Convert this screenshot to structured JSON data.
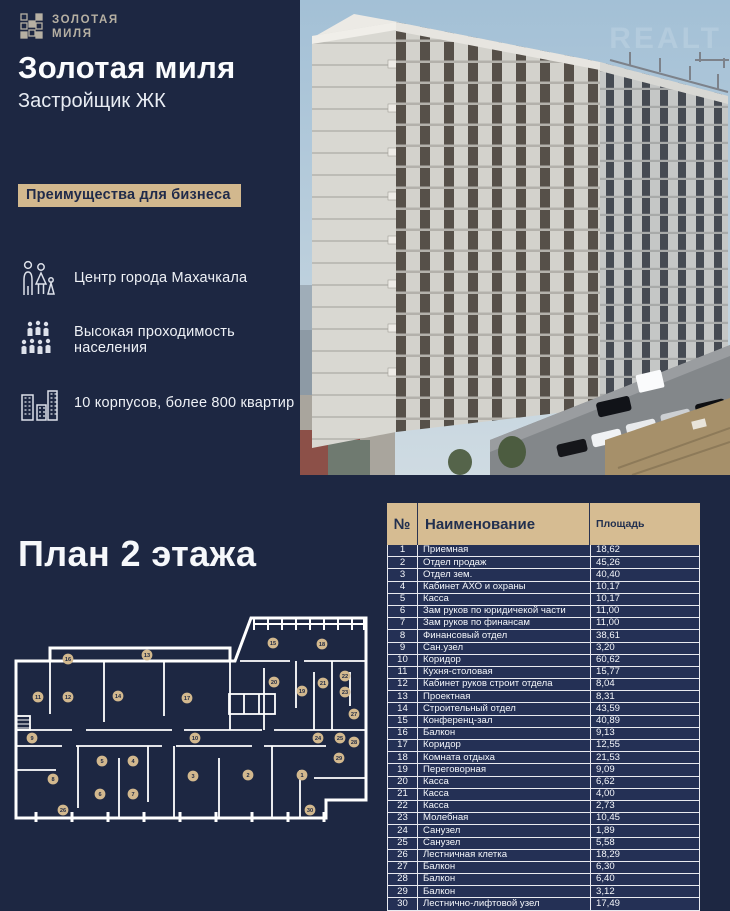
{
  "brand": {
    "logo_line1": "ЗОЛОТАЯ",
    "logo_line2": "МИЛЯ",
    "title": "Золотая миля",
    "subtitle": "Застройщик ЖК"
  },
  "badge": {
    "label": "Преимущества для бизнеса"
  },
  "features": [
    {
      "icon": "family-icon",
      "label": "Центр города Махачкала"
    },
    {
      "icon": "crowd-icon",
      "label": "Высокая проходимость населения"
    },
    {
      "icon": "buildings-icon",
      "label": "10 корпусов, более 800 квартир"
    }
  ],
  "photo": {
    "watermark": "REALT"
  },
  "plan": {
    "heading": "План 2 этажа",
    "markers": [
      {
        "n": 16,
        "x": 54,
        "y": 49
      },
      {
        "n": 13,
        "x": 133,
        "y": 45
      },
      {
        "n": 15,
        "x": 259,
        "y": 33
      },
      {
        "n": 18,
        "x": 308,
        "y": 34
      },
      {
        "n": 11,
        "x": 24,
        "y": 87
      },
      {
        "n": 12,
        "x": 54,
        "y": 87
      },
      {
        "n": 14,
        "x": 104,
        "y": 86
      },
      {
        "n": 17,
        "x": 173,
        "y": 88
      },
      {
        "n": 20,
        "x": 260,
        "y": 72
      },
      {
        "n": 19,
        "x": 288,
        "y": 81
      },
      {
        "n": 21,
        "x": 309,
        "y": 73
      },
      {
        "n": 22,
        "x": 331,
        "y": 66
      },
      {
        "n": 23,
        "x": 331,
        "y": 82
      },
      {
        "n": 9,
        "x": 18,
        "y": 128
      },
      {
        "n": 10,
        "x": 181,
        "y": 128
      },
      {
        "n": 24,
        "x": 304,
        "y": 128
      },
      {
        "n": 25,
        "x": 326,
        "y": 128
      },
      {
        "n": 27,
        "x": 340,
        "y": 104
      },
      {
        "n": 28,
        "x": 340,
        "y": 132
      },
      {
        "n": 29,
        "x": 325,
        "y": 148
      },
      {
        "n": 8,
        "x": 39,
        "y": 169
      },
      {
        "n": 5,
        "x": 88,
        "y": 151
      },
      {
        "n": 4,
        "x": 119,
        "y": 151
      },
      {
        "n": 3,
        "x": 179,
        "y": 166
      },
      {
        "n": 2,
        "x": 234,
        "y": 165
      },
      {
        "n": 1,
        "x": 288,
        "y": 165
      },
      {
        "n": 6,
        "x": 86,
        "y": 184
      },
      {
        "n": 7,
        "x": 119,
        "y": 184
      },
      {
        "n": 26,
        "x": 49,
        "y": 200
      },
      {
        "n": 30,
        "x": 296,
        "y": 200
      }
    ]
  },
  "table": {
    "columns": {
      "num": "№",
      "name": "Наименование",
      "area": "Площадь"
    },
    "rows": [
      {
        "n": "1",
        "name": "Приемная",
        "area": "18,62"
      },
      {
        "n": "2",
        "name": "Отдел продаж",
        "area": "45,26"
      },
      {
        "n": "3",
        "name": "Отдел зем.",
        "area": "40,40"
      },
      {
        "n": "4",
        "name": "Кабинет АХО и охраны",
        "area": "10,17"
      },
      {
        "n": "5",
        "name": "Касса",
        "area": "10,17"
      },
      {
        "n": "6",
        "name": "Зам руков по юридичекой части",
        "area": "11,00"
      },
      {
        "n": "7",
        "name": "Зам руков по финансам",
        "area": "11,00"
      },
      {
        "n": "8",
        "name": "Финансовый отдел",
        "area": "38,61"
      },
      {
        "n": "9",
        "name": "Сан.узел",
        "area": "3,20"
      },
      {
        "n": "10",
        "name": "Коридор",
        "area": "60,62"
      },
      {
        "n": "11",
        "name": "Кухня-столовая",
        "area": "15,77"
      },
      {
        "n": "12",
        "name": "Кабинет руков строит отдела",
        "area": "8,04"
      },
      {
        "n": "13",
        "name": "Проектная",
        "area": "8,31"
      },
      {
        "n": "14",
        "name": "Строительный отдел",
        "area": "43,59"
      },
      {
        "n": "15",
        "name": "Конференц-зал",
        "area": "40,89"
      },
      {
        "n": "16",
        "name": "Балкон",
        "area": "9,13"
      },
      {
        "n": "17",
        "name": "Коридор",
        "area": "12,55"
      },
      {
        "n": "18",
        "name": "Комната отдыха",
        "area": "21,53"
      },
      {
        "n": "19",
        "name": "Переговорная",
        "area": "9,09"
      },
      {
        "n": "20",
        "name": "Касса",
        "area": "6,62"
      },
      {
        "n": "21",
        "name": "Касса",
        "area": "4,00"
      },
      {
        "n": "22",
        "name": "Касса",
        "area": "2,73"
      },
      {
        "n": "23",
        "name": "Молебная",
        "area": "10,45"
      },
      {
        "n": "24",
        "name": "Санузел",
        "area": "1,89"
      },
      {
        "n": "25",
        "name": "Санузел",
        "area": "5,58"
      },
      {
        "n": "26",
        "name": "Лестничная клетка",
        "area": "18,29"
      },
      {
        "n": "27",
        "name": "Балкон",
        "area": "6,30"
      },
      {
        "n": "28",
        "name": "Балкон",
        "area": "6,40"
      },
      {
        "n": "29",
        "name": "Балкон",
        "area": "3,12"
      },
      {
        "n": "30",
        "name": "Лестнично-лифтовой узел",
        "area": "17,49"
      }
    ]
  },
  "colors": {
    "navy": "#1d2742",
    "row_navy": "#243055",
    "beige": "#d2b88e",
    "header_beige": "#d6bc92",
    "text_light": "#f2f4f8"
  }
}
